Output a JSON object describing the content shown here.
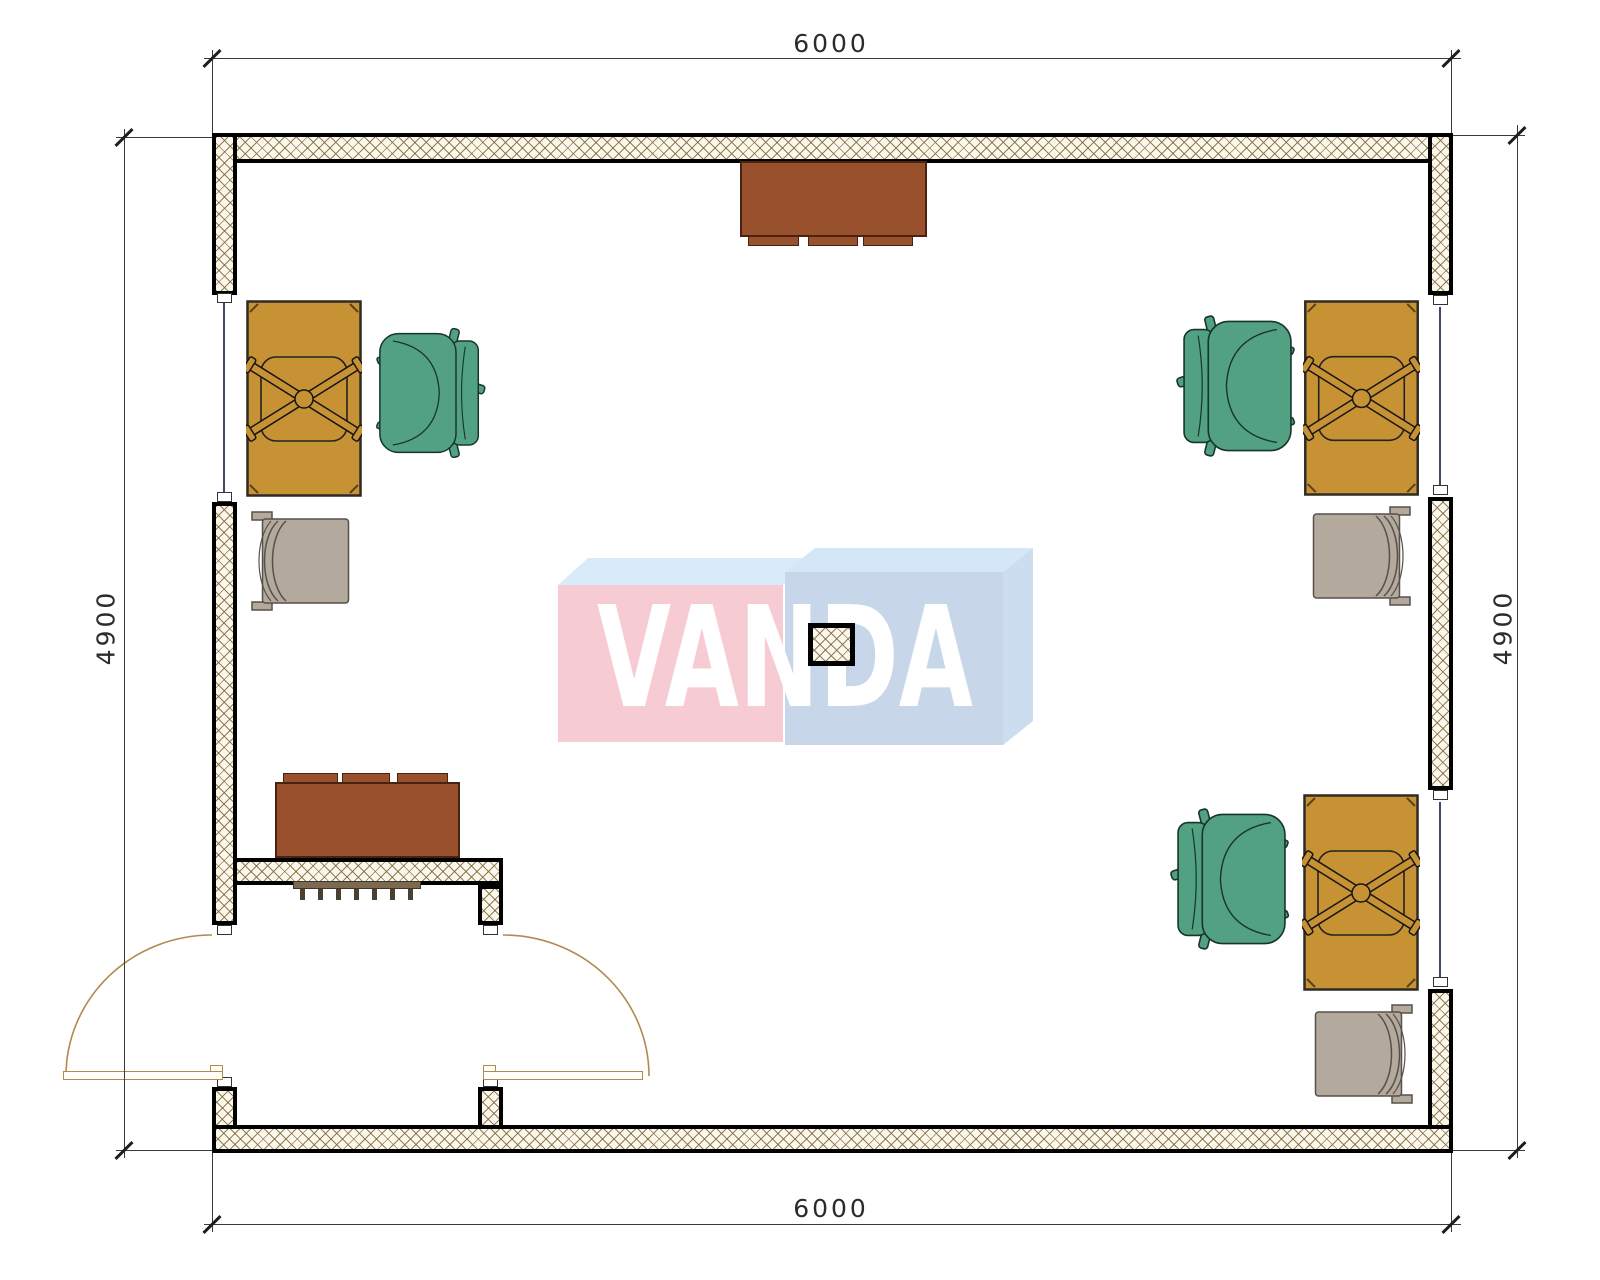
{
  "title": "Office room floor plan drawing",
  "watermark": {
    "text": "VANDA",
    "left_box_color": "#F7CBD3",
    "right_box_color": "#C7D7E9",
    "top_face_color": "#D7EBF8"
  },
  "dimensions": {
    "top": "6000",
    "bottom": "6000",
    "left": "4900",
    "right": "4900"
  },
  "colors": {
    "wall_fill": "#FBF7EB",
    "wall_hatch_line": "#8C7B55",
    "wall_border": "#000000",
    "desk": "#C79234",
    "office_chair": "#53A183",
    "lounge_chair": "#B3A99D",
    "sideboard": "#98502D",
    "radiator": "#7B6951",
    "door_swing": "#B08A50",
    "window_line": "#3D4A66",
    "dimension_text": "#2B2B2B"
  },
  "furniture": [
    {
      "id": "desk-top-left",
      "type": "desk-with-task-chair-base"
    },
    {
      "id": "office-chair-top-left",
      "type": "office-chair"
    },
    {
      "id": "lounge-chair-top-left",
      "type": "lounge-chair"
    },
    {
      "id": "sideboard-top-center",
      "type": "sideboard"
    },
    {
      "id": "desk-top-right",
      "type": "desk-with-task-chair-base"
    },
    {
      "id": "office-chair-top-right",
      "type": "office-chair"
    },
    {
      "id": "lounge-chair-top-right",
      "type": "lounge-chair"
    },
    {
      "id": "desk-bottom-right",
      "type": "desk-with-task-chair-base"
    },
    {
      "id": "office-chair-bottom-right",
      "type": "office-chair"
    },
    {
      "id": "lounge-chair-bottom-right",
      "type": "lounge-chair"
    },
    {
      "id": "sideboard-bottom-left",
      "type": "sideboard"
    },
    {
      "id": "radiator-entry",
      "type": "radiator"
    },
    {
      "id": "center-column",
      "type": "structural-column"
    },
    {
      "id": "entry-double-door",
      "type": "double-door"
    }
  ],
  "openings": {
    "windows": 3,
    "doors": 1
  }
}
